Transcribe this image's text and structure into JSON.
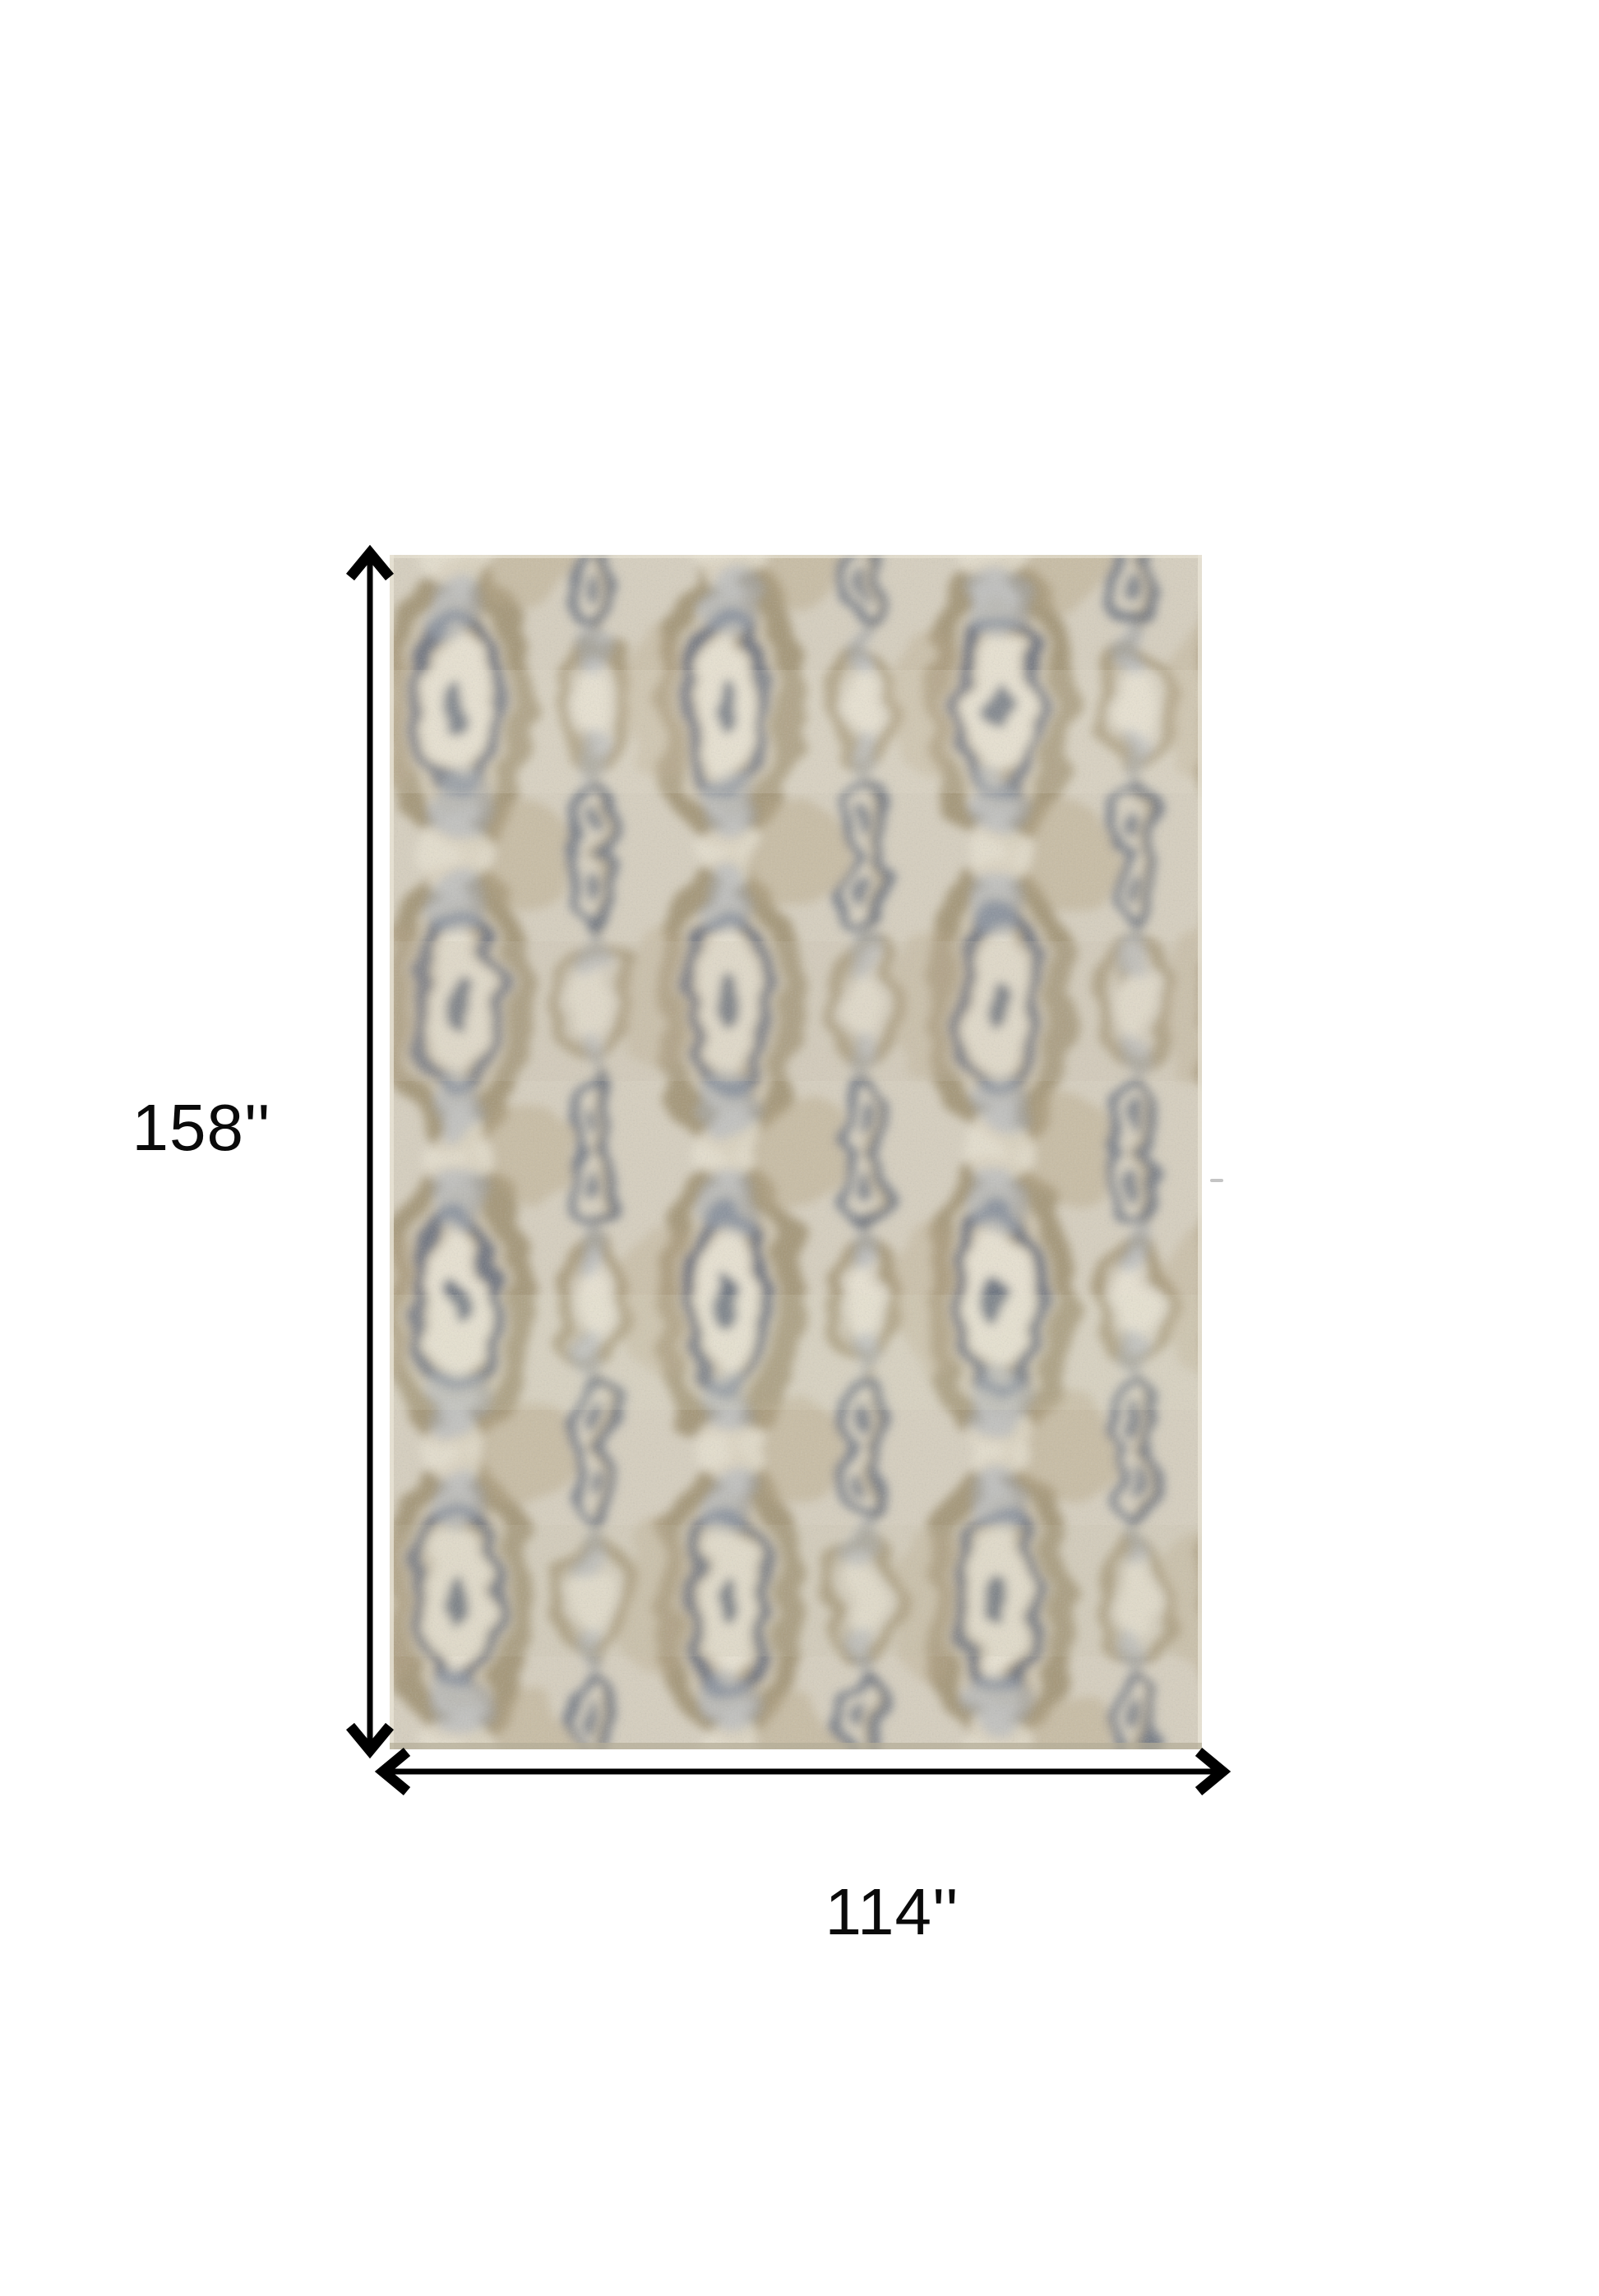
{
  "diagram": {
    "height_label": "158''",
    "width_label": "114''",
    "arrow_color": "#000000",
    "label_color": "#0a0a0a",
    "background": "#ffffff"
  },
  "rug": {
    "description": "distressed ikat ogee pattern area rug in cream, taupe and slate blue",
    "colors": {
      "base": "#d6cfbf",
      "cream": "#e7e1d1",
      "tan": "#b6a685",
      "taupe": "#9d8d6d",
      "slate": "#5f6878",
      "slate_light": "#a9b1be",
      "band": "#c9c0ab",
      "edge": "#e9e4d6",
      "shadow": "#b3ac97",
      "stray_mark": "#c4c4c4"
    }
  }
}
